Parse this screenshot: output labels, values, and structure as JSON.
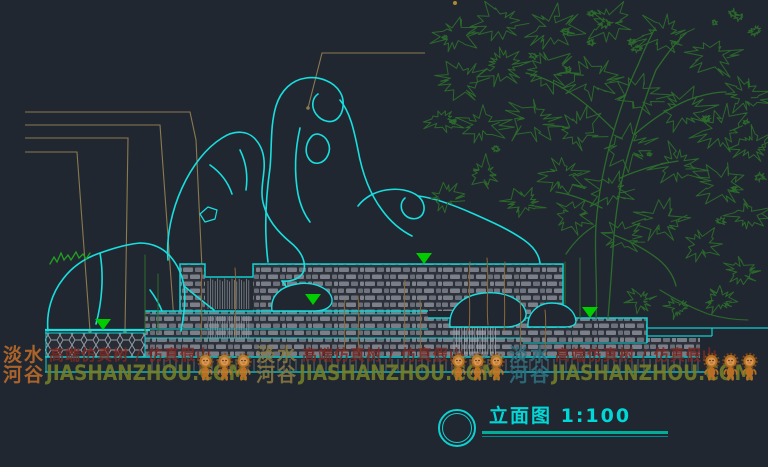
{
  "drawing": {
    "title": "立面图 1:100",
    "scale": "1:100"
  },
  "watermark": {
    "brand_line1": "淡水",
    "brand_line2": "河谷",
    "tagline": "高端仿真树 / 仿真假山",
    "domain": "JIASHANZHOU.COM",
    "mascot": "lion-mascot",
    "groups": [
      {
        "brand_color": "#bf6c2a"
      },
      {
        "brand_color": "#8a7a40"
      },
      {
        "brand_color": "#2f7080"
      }
    ]
  },
  "symbols": {
    "water_level_marker": "inverted-triangle",
    "water_level_count": 4
  },
  "colors": {
    "background": "#212731",
    "outline_cyan": "#0fd0d0",
    "tree_green": "#2c6b2c",
    "leader_tan": "#8a7a4e",
    "marker_green": "#00cc00",
    "masonry_gray": "#787d88",
    "watermark_tagline": "#7e2822",
    "watermark_domain": "#76802a",
    "title_text": "#00d8d8"
  }
}
